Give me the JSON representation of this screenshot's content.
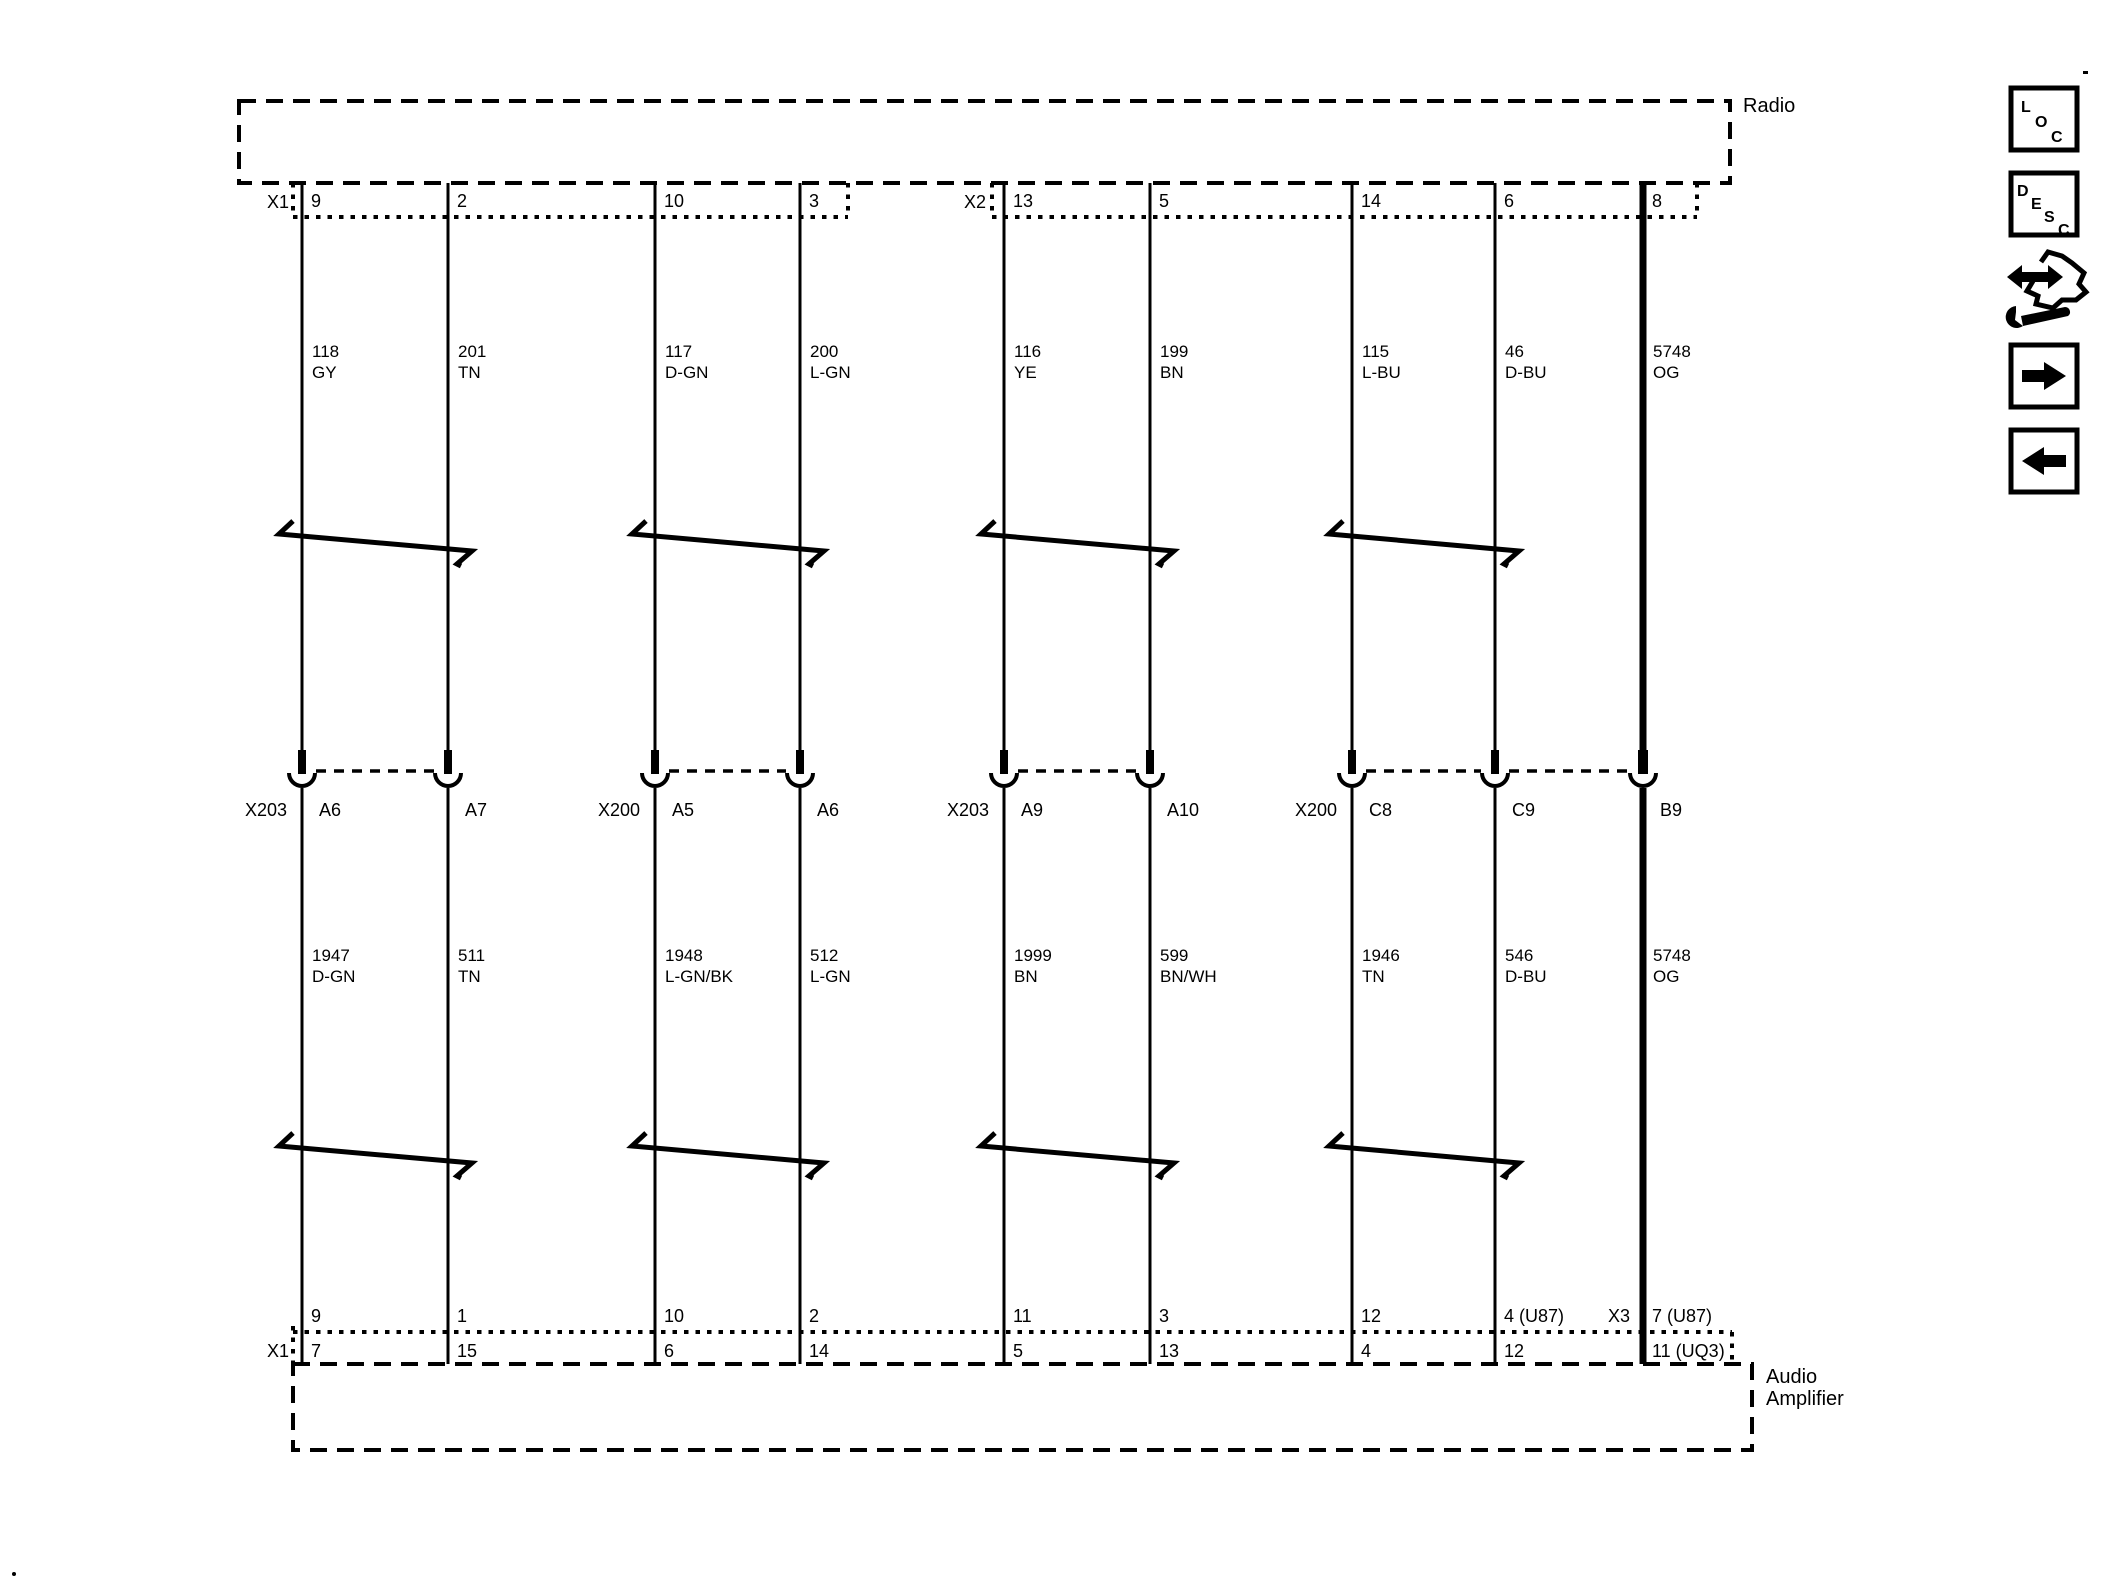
{
  "devices": {
    "radio": {
      "label": "Radio"
    },
    "amplifier": {
      "label_line1": "Audio",
      "label_line2": "Amplifier"
    }
  },
  "top_connectors": {
    "x1": "X1",
    "x2": "X2"
  },
  "bottom_connectors": {
    "x1": "X1",
    "x3": "X3"
  },
  "inline_groups": [
    {
      "name": "X203"
    },
    {
      "name": "X200"
    },
    {
      "name": "X203"
    },
    {
      "name": "X200"
    }
  ],
  "circuits": [
    {
      "radio_pin": "9",
      "wire_id": "118",
      "wire_color": "GY",
      "inline_pin": "A6",
      "lower_wire_id": "1947",
      "lower_wire_color": "D-GN",
      "amp_pin_top": "9",
      "amp_pin_bottom": "7"
    },
    {
      "radio_pin": "2",
      "wire_id": "201",
      "wire_color": "TN",
      "inline_pin": "A7",
      "lower_wire_id": "511",
      "lower_wire_color": "TN",
      "amp_pin_top": "1",
      "amp_pin_bottom": "15"
    },
    {
      "radio_pin": "10",
      "wire_id": "117",
      "wire_color": "D-GN",
      "inline_pin": "A5",
      "lower_wire_id": "1948",
      "lower_wire_color": "L-GN/BK",
      "amp_pin_top": "10",
      "amp_pin_bottom": "6"
    },
    {
      "radio_pin": "3",
      "wire_id": "200",
      "wire_color": "L-GN",
      "inline_pin": "A6",
      "lower_wire_id": "512",
      "lower_wire_color": "L-GN",
      "amp_pin_top": "2",
      "amp_pin_bottom": "14"
    },
    {
      "radio_pin": "13",
      "wire_id": "116",
      "wire_color": "YE",
      "inline_pin": "A9",
      "lower_wire_id": "1999",
      "lower_wire_color": "BN",
      "amp_pin_top": "11",
      "amp_pin_bottom": "5"
    },
    {
      "radio_pin": "5",
      "wire_id": "199",
      "wire_color": "BN",
      "inline_pin": "A10",
      "lower_wire_id": "599",
      "lower_wire_color": "BN/WH",
      "amp_pin_top": "3",
      "amp_pin_bottom": "13"
    },
    {
      "radio_pin": "14",
      "wire_id": "115",
      "wire_color": "L-BU",
      "inline_pin": "C8",
      "lower_wire_id": "1946",
      "lower_wire_color": "TN",
      "amp_pin_top": "12",
      "amp_pin_bottom": "4"
    },
    {
      "radio_pin": "6",
      "wire_id": "46",
      "wire_color": "D-BU",
      "inline_pin": "C9",
      "lower_wire_id": "546",
      "lower_wire_color": "D-BU",
      "amp_pin_top": "4 (U87)",
      "amp_pin_bottom": "12"
    },
    {
      "radio_pin": "8",
      "wire_id": "5748",
      "wire_color": "OG",
      "inline_pin": "B9",
      "lower_wire_id": "5748",
      "lower_wire_color": "OG",
      "amp_pin_top": "7 (U87)",
      "amp_pin_bottom": "11 (UQ3)"
    }
  ],
  "sidebar": {
    "loc_letters": [
      "L",
      "O",
      "C"
    ],
    "desc_letters": [
      "D",
      "E",
      "S",
      "C"
    ],
    "icon_names": [
      "loc-button",
      "desc-button",
      "jump-tool-icon",
      "forward-arrow-button",
      "back-arrow-button"
    ],
    "ink_color": "#000000",
    "background_color": "#ffffff"
  }
}
